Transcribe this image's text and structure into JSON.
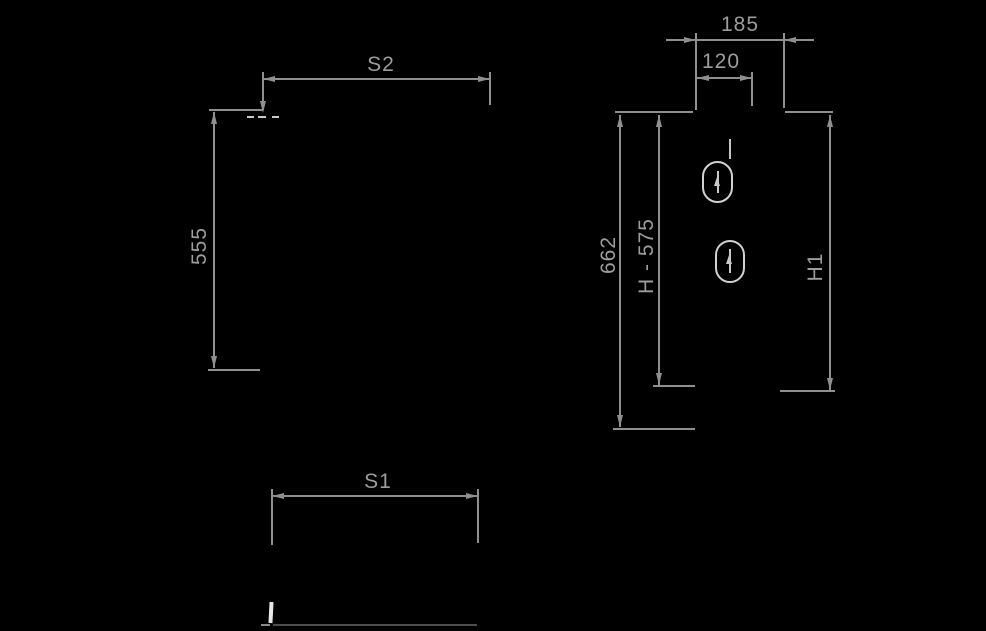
{
  "drawing": {
    "kind": "technical-dimension-drawing",
    "colors": {
      "background": "#000000",
      "dimension_lines": "#8f8f8f",
      "dimension_text": "#9d9d9d",
      "object_light": "#d2d2d2",
      "object_white": "#e8e8e8",
      "object_dark_edge": "#4d4d4d"
    },
    "labels": {
      "s2": "S2",
      "height_555": "555",
      "s1": "S1",
      "width_185": "185",
      "offset_120": "120",
      "height_662": "662",
      "height_formula": "H - 575",
      "height_h1": "H1"
    },
    "features": {
      "mounting_slot_count": 2
    }
  }
}
